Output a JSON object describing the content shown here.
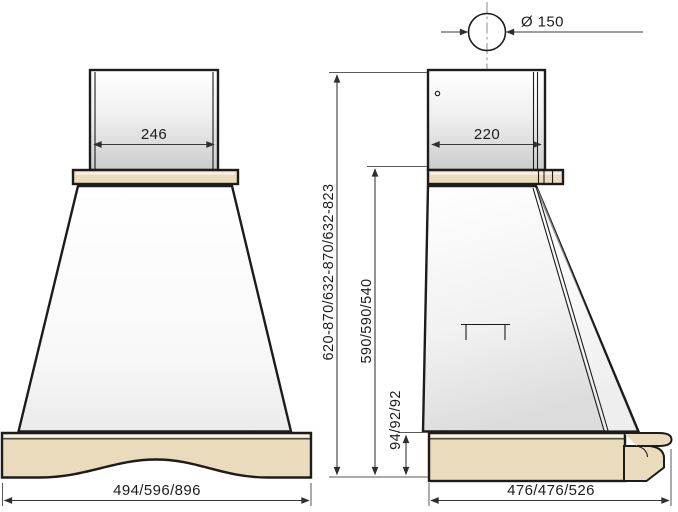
{
  "colors": {
    "wood": "#e9dbbb",
    "outline": "#1c1c1c",
    "dimension_line": "#3a3a3a",
    "centerline": "#989898"
  },
  "front_view": {
    "chimney_width": "246",
    "hood_width": "494/596/896"
  },
  "side_view": {
    "duct_diameter": "Ø 150",
    "chimney_depth": "220",
    "total_height": "620-870/632-870/632-823",
    "body_height": "590/590/540",
    "plinth_height": "94/92/92",
    "hood_depth": "476/476/526"
  }
}
